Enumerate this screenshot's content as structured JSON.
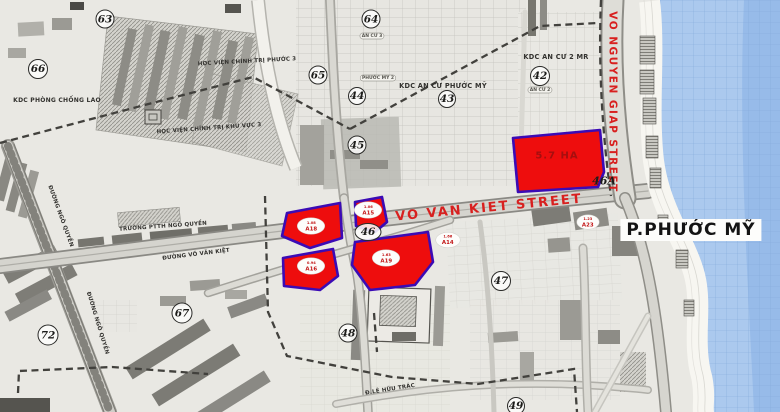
{
  "map": {
    "district_label": "P.PHƯỚC MỸ",
    "highlight": {
      "main_parcel_label": "5.7 HA",
      "lot_ovals": [
        {
          "area": "1.08",
          "code": "A18"
        },
        {
          "area": "1.06",
          "code": "A15"
        },
        {
          "area": "0.94",
          "code": "A16"
        },
        {
          "area": "1.63",
          "code": "A19"
        },
        {
          "area": "1.66",
          "code": "A14"
        },
        {
          "area": "1.23",
          "code": "A23"
        }
      ]
    },
    "streets": {
      "vo_nguyen_giap": "VO NGUYEN GIAP STREET",
      "vo_van_kiet": "VO VAN KIET STREET",
      "duong_vo_van_kiet": "ĐƯỜNG VÕ VĂN KIỆT",
      "duong_ngo_quyen": "ĐƯỜNG NGÔ QUYỀN",
      "le_huu_trac": "Đ.LÊ HỮU TRÁC"
    },
    "areas": {
      "kdc_phong_chong_lao": "KDC PHÒNG CHỐNG LAO",
      "hoc_vien_chinh_tri_phuoc_3": "HỌC VIỆN CHÍNH TRỊ PHƯỚC 3",
      "hoc_vien_chinh_tri_khu_vuc_3": "HỌC VIỆN CHÍNH TRỊ KHU VỰC 3",
      "kdc_an_cu_phuoc_my": "KDC AN CƯ PHƯỚC MỸ",
      "kdc_an_cu_2_mr": "KDC AN CƯ 2 MR",
      "truong_ptth_ngo_quyen": "TRƯỜNG PTTH NGÔ QUYỀN",
      "badge_an_cu_3": "AN CƯ 3",
      "badge_an_cu_2": "AN CƯ 2",
      "badge_phuoc_my_2": "PHƯỚC MỸ 2"
    },
    "zone_numbers": [
      "63",
      "64",
      "65",
      "66",
      "42",
      "43",
      "44",
      "45",
      "46",
      "46A",
      "47",
      "48",
      "49",
      "67",
      "72"
    ],
    "colors": {
      "parcel_fill": "#ee0d0d",
      "parcel_border": "#3b0bb5",
      "street_label_red": "#d8201f",
      "sea": "#abc9ee"
    }
  }
}
